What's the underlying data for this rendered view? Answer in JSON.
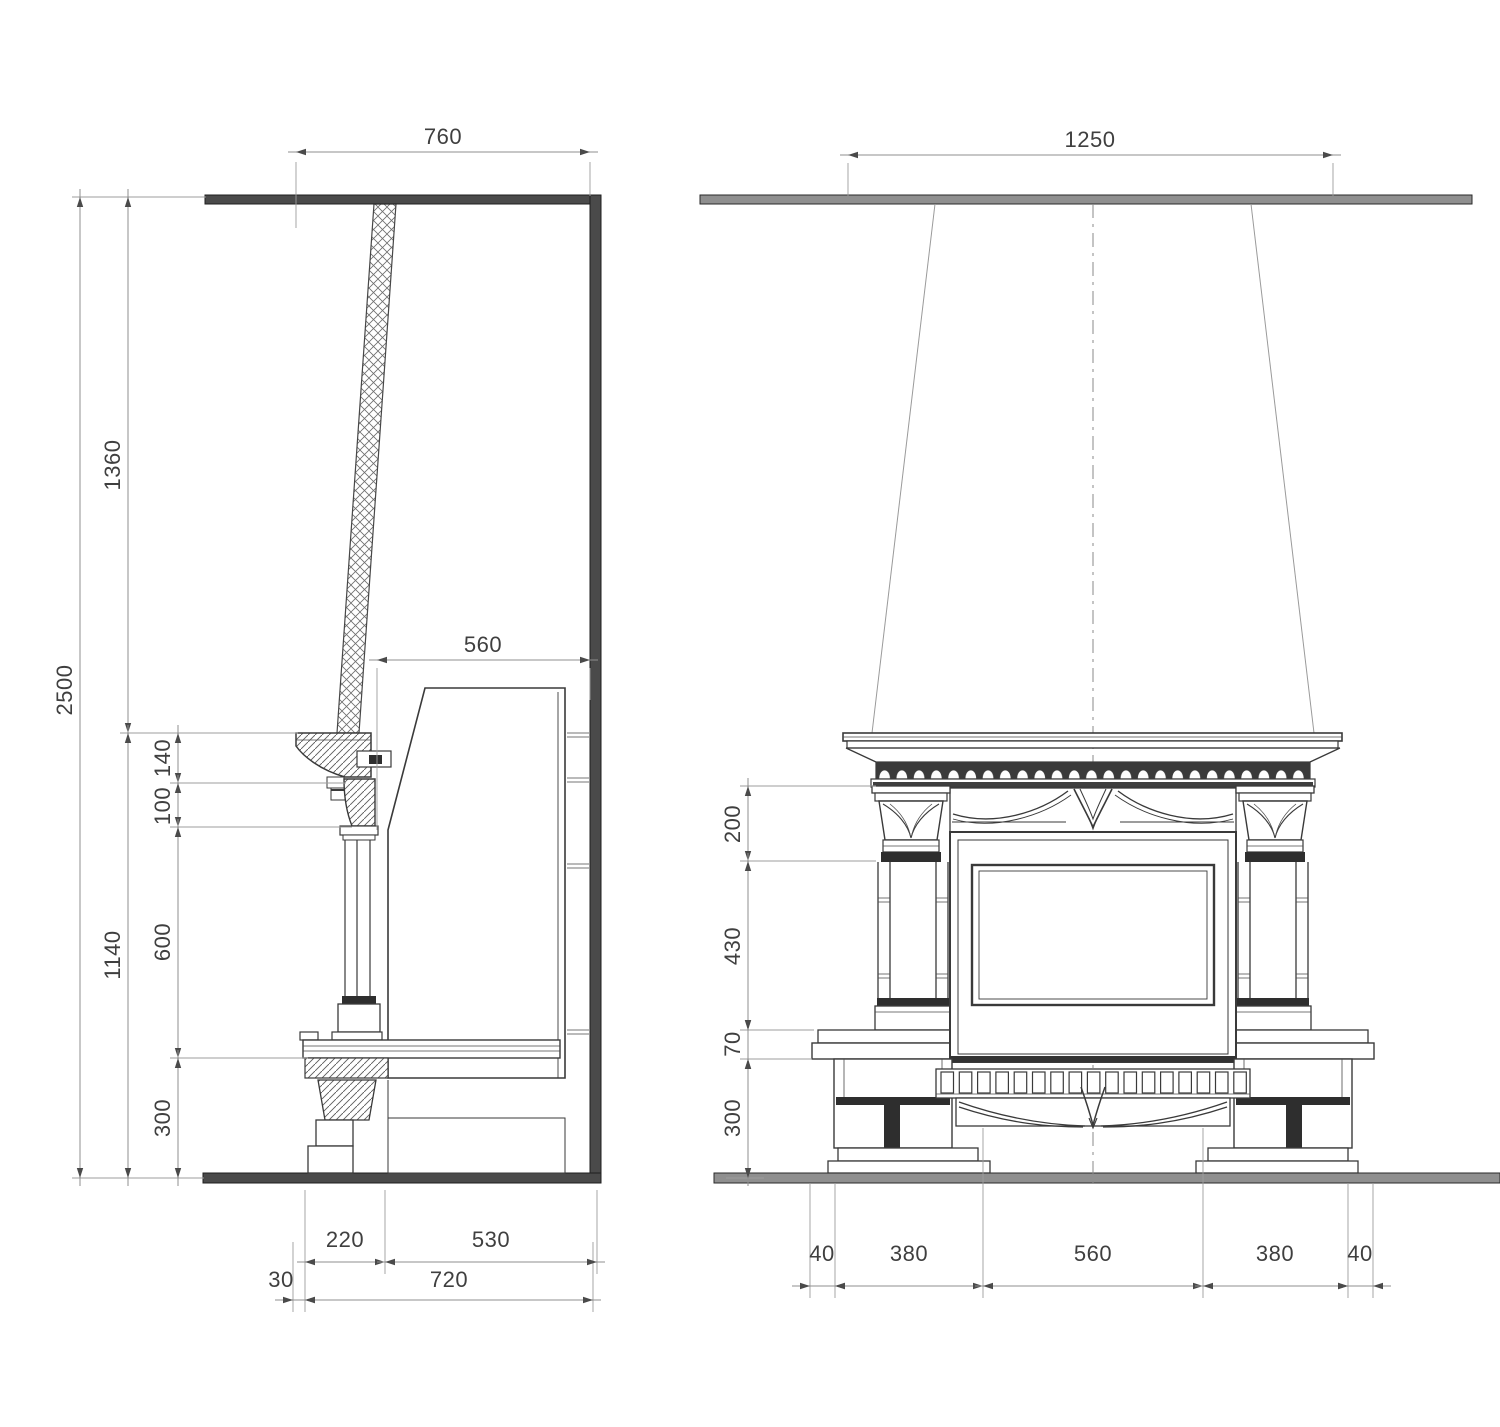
{
  "drawing": {
    "type": "fireplace construction drawing",
    "side_view": {
      "label": "side section",
      "dims": {
        "top_width": "760",
        "total_height": "2500",
        "upper_height": "1360",
        "lower_height": "1140",
        "cornice_height": "140",
        "capital_height": "100",
        "column_height": "600",
        "base_height": "300",
        "flue_depth": "560",
        "hearth_depth": "220",
        "rear_depth": "530",
        "overhang": "30",
        "total_depth": "720"
      }
    },
    "front_view": {
      "label": "front elevation",
      "dims": {
        "shelf_width": "1250",
        "capital_height": "200",
        "column_height": "430",
        "hearth_height": "70",
        "plinth_height": "300",
        "left_overhang": "40",
        "left_pier": "380",
        "opening_width": "560",
        "right_pier": "380",
        "right_overhang": "40"
      }
    },
    "colors": {
      "line": "#3a3a3a",
      "dim_line": "#8f8f8f",
      "wall_dark": "#4a4a4a",
      "wall_light": "#8f8f8f",
      "text": "#3f3f3f"
    }
  }
}
